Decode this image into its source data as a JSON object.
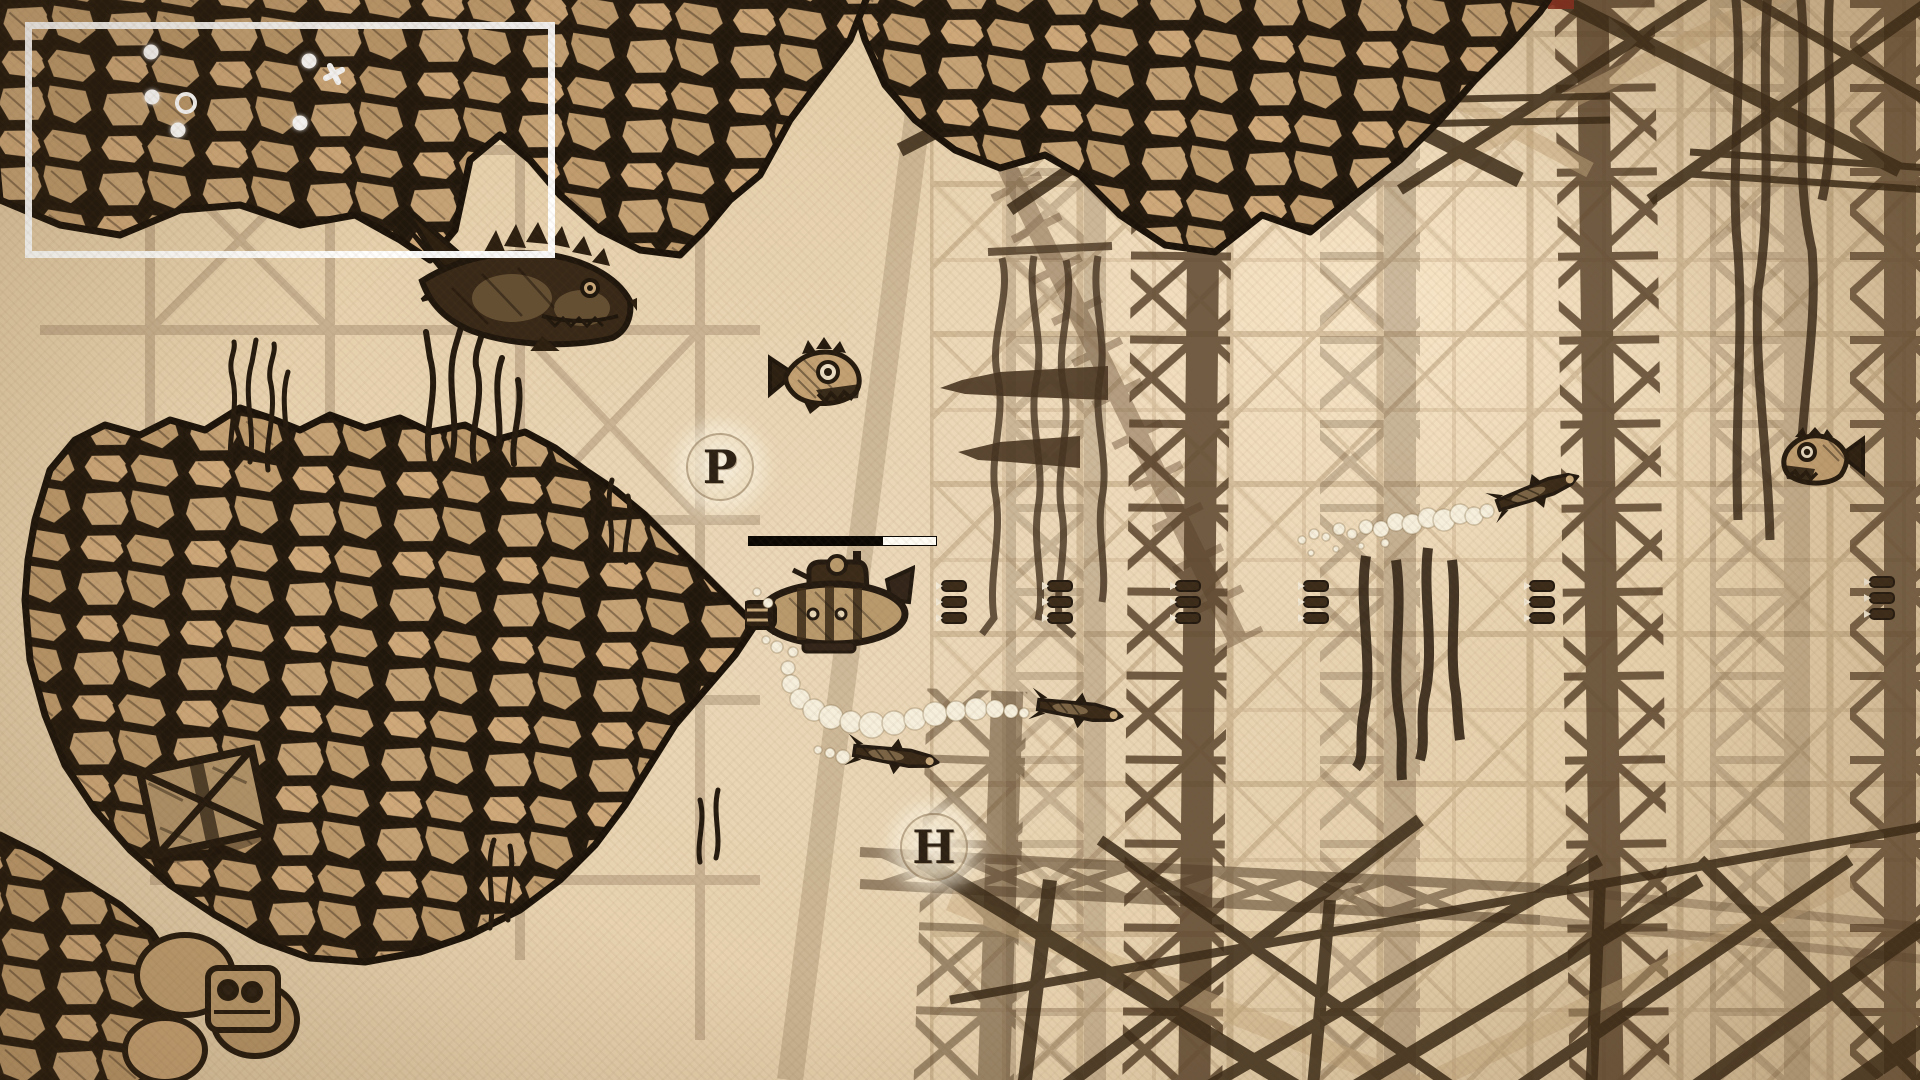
{
  "game": {
    "scene": "underwater side-scroller, sepia hand-sketched style",
    "visible_text": [
      "P",
      "H"
    ]
  },
  "hud": {
    "minimap": {
      "x": 25,
      "y": 22,
      "width": 530,
      "height": 236,
      "dots": [
        {
          "x": 119,
          "y": 23
        },
        {
          "x": 277,
          "y": 32
        },
        {
          "x": 120,
          "y": 68
        },
        {
          "x": 146,
          "y": 101
        },
        {
          "x": 268,
          "y": 94
        }
      ],
      "ring": {
        "x": 154,
        "y": 74
      },
      "cross": {
        "x": 302,
        "y": 45
      }
    },
    "power_bar": {
      "x": 748,
      "y": 536,
      "width": 189,
      "height": 10,
      "fill_percent": 28,
      "fill_side": "right",
      "bar_color": "#0a0703",
      "fill_color": "#fffdf6"
    },
    "pickups": [
      {
        "label": "P",
        "x": 686,
        "y": 433
      },
      {
        "label": "H",
        "x": 900,
        "y": 813
      }
    ]
  },
  "entities": {
    "player_submarine": {
      "x": 745,
      "y": 550,
      "facing": "left"
    },
    "mech_shark": {
      "x": 392,
      "y": 196,
      "facing": "right"
    },
    "piranha_center": {
      "x": 768,
      "y": 336,
      "facing": "right"
    },
    "piranha_right": {
      "x": 1779,
      "y": 427,
      "facing": "left"
    },
    "torpedoes": [
      {
        "x": 846,
        "y": 738,
        "angle": 8
      },
      {
        "x": 1030,
        "y": 692,
        "angle": 8
      },
      {
        "x": 1488,
        "y": 474,
        "angle": -20
      }
    ],
    "ammo_pickups": [
      {
        "x": 934,
        "y": 579
      },
      {
        "x": 1040,
        "y": 579
      },
      {
        "x": 1168,
        "y": 579
      },
      {
        "x": 1296,
        "y": 579
      },
      {
        "x": 1522,
        "y": 579
      },
      {
        "x": 1862,
        "y": 575
      }
    ],
    "crate": {
      "x": 140,
      "y": 752,
      "angle": -12
    }
  },
  "colors": {
    "parchment": "#e9d6b6",
    "ink": "#2b2014",
    "stone": "#c6a376",
    "faded_structure": "#ab906a",
    "dark_truss": "#3a2a17",
    "bubble": "#f6efdc",
    "ui_white": "#ffffff"
  }
}
